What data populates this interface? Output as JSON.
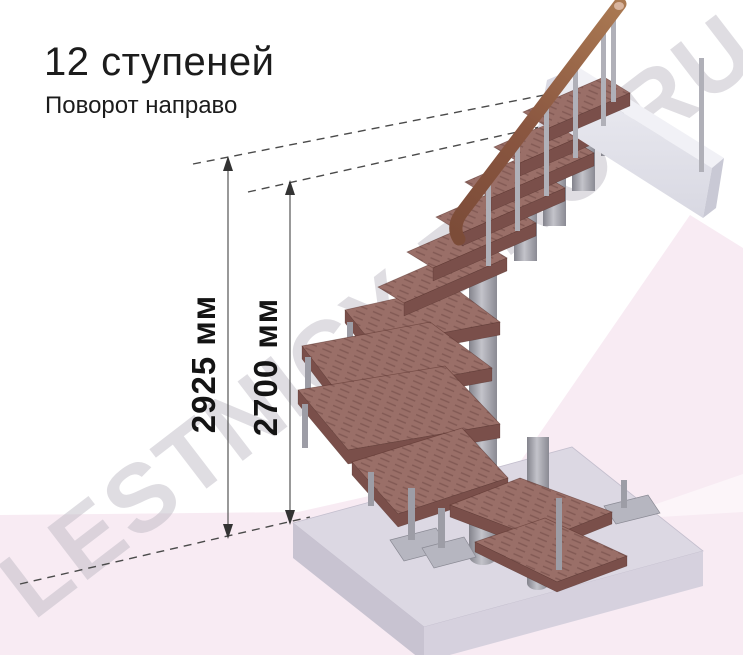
{
  "header": {
    "title": "12 ступеней",
    "subtitle": "Поворот направо"
  },
  "dimensions": {
    "overall_height": {
      "label": "2925 мм"
    },
    "floor_height": {
      "label": "2700 мм"
    }
  },
  "watermark": {
    "text": "LESTNICY-PRO.RU"
  },
  "staircase": {
    "steps_count": 12,
    "turn_direction": "направо",
    "upper_straight_steps": 6,
    "winder_steps": 4,
    "lower_steps": 2
  },
  "colors": {
    "step-wood": "#9a6f68",
    "step-front": "#7a4f4a",
    "metal": "#9a9aa3",
    "handrail": "#94604a",
    "floor-slab": "#dcd8e3",
    "background-pink": "#f8ebf3",
    "watermark-grey": "#b9b6c0",
    "dimension-text": "#141414",
    "title-text": "#1c1c1c"
  }
}
